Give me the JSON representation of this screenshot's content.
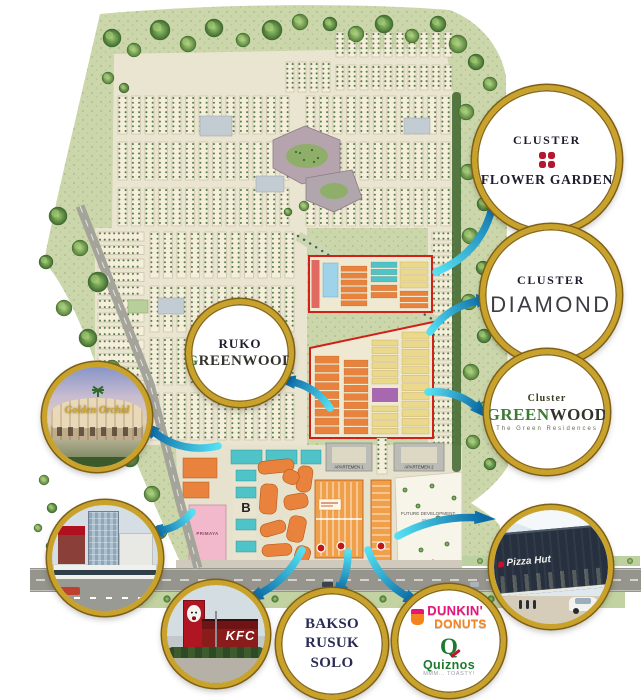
{
  "callouts": {
    "flower_garden": {
      "line1": "CLUSTER",
      "line2": "FLOWER GARDEN"
    },
    "diamond": {
      "line1": "CLUSTER",
      "line2": "DIAMOND"
    },
    "greenwood": {
      "line1": "Cluster",
      "name_green": "GREEN",
      "name_rest": "WOOD",
      "subtitle": "The Green Residences"
    },
    "ruko_greenwood": {
      "line1": "RUKO",
      "name_green": "G",
      "name_rest": "REENWOOD"
    },
    "golden_orchid": {
      "sign": "Golden Orchid"
    },
    "kfc": {
      "sign": "KFC"
    },
    "bakso_rusuk": {
      "line1": "BAKSO RUSUK",
      "line2": "SOLO"
    },
    "dunkin_quiznos": {
      "dunkin_line1": "DUNKIN'",
      "dunkin_line2": "DONUTS",
      "quiznos_q": "Q",
      "quiznos_name": "Quiznos",
      "quiznos_tagline": "MMM... TOASTY!"
    },
    "pizza_hut": {
      "sign": "Pizza Hut"
    }
  },
  "map": {
    "labels": {
      "primaya": "PRIMAYA",
      "block_b": "B",
      "apartemen_1": "APARTEMEN 1",
      "apartemen_2": "APARTEMEN 2",
      "future_dev_1": "FUTURE DEVELOPMENT",
      "future_dev_2": "Blok A"
    }
  },
  "colors": {
    "gold_ring": "#c9a22c",
    "arrow_teal_light": "#55dff2",
    "arrow_teal_dark": "#0b6ba6",
    "map_green": "#cbd7ab",
    "housing_beige": "#f4eedb",
    "cluster_red_outline": "#d02018",
    "orange_block": "#e8823c",
    "teal_block": "#4fc3c7",
    "yellow_block": "#ead98a",
    "purple_block": "#a868b0",
    "pink_building": "#f2b8cc",
    "flower_red": "#b5172f",
    "greenwood_green": "#3e7a33",
    "dunkin_pink": "#e5157a",
    "dunkin_orange": "#f5821f",
    "quiznos_green": "#1c7a2e",
    "kfc_red": "#b01622"
  }
}
